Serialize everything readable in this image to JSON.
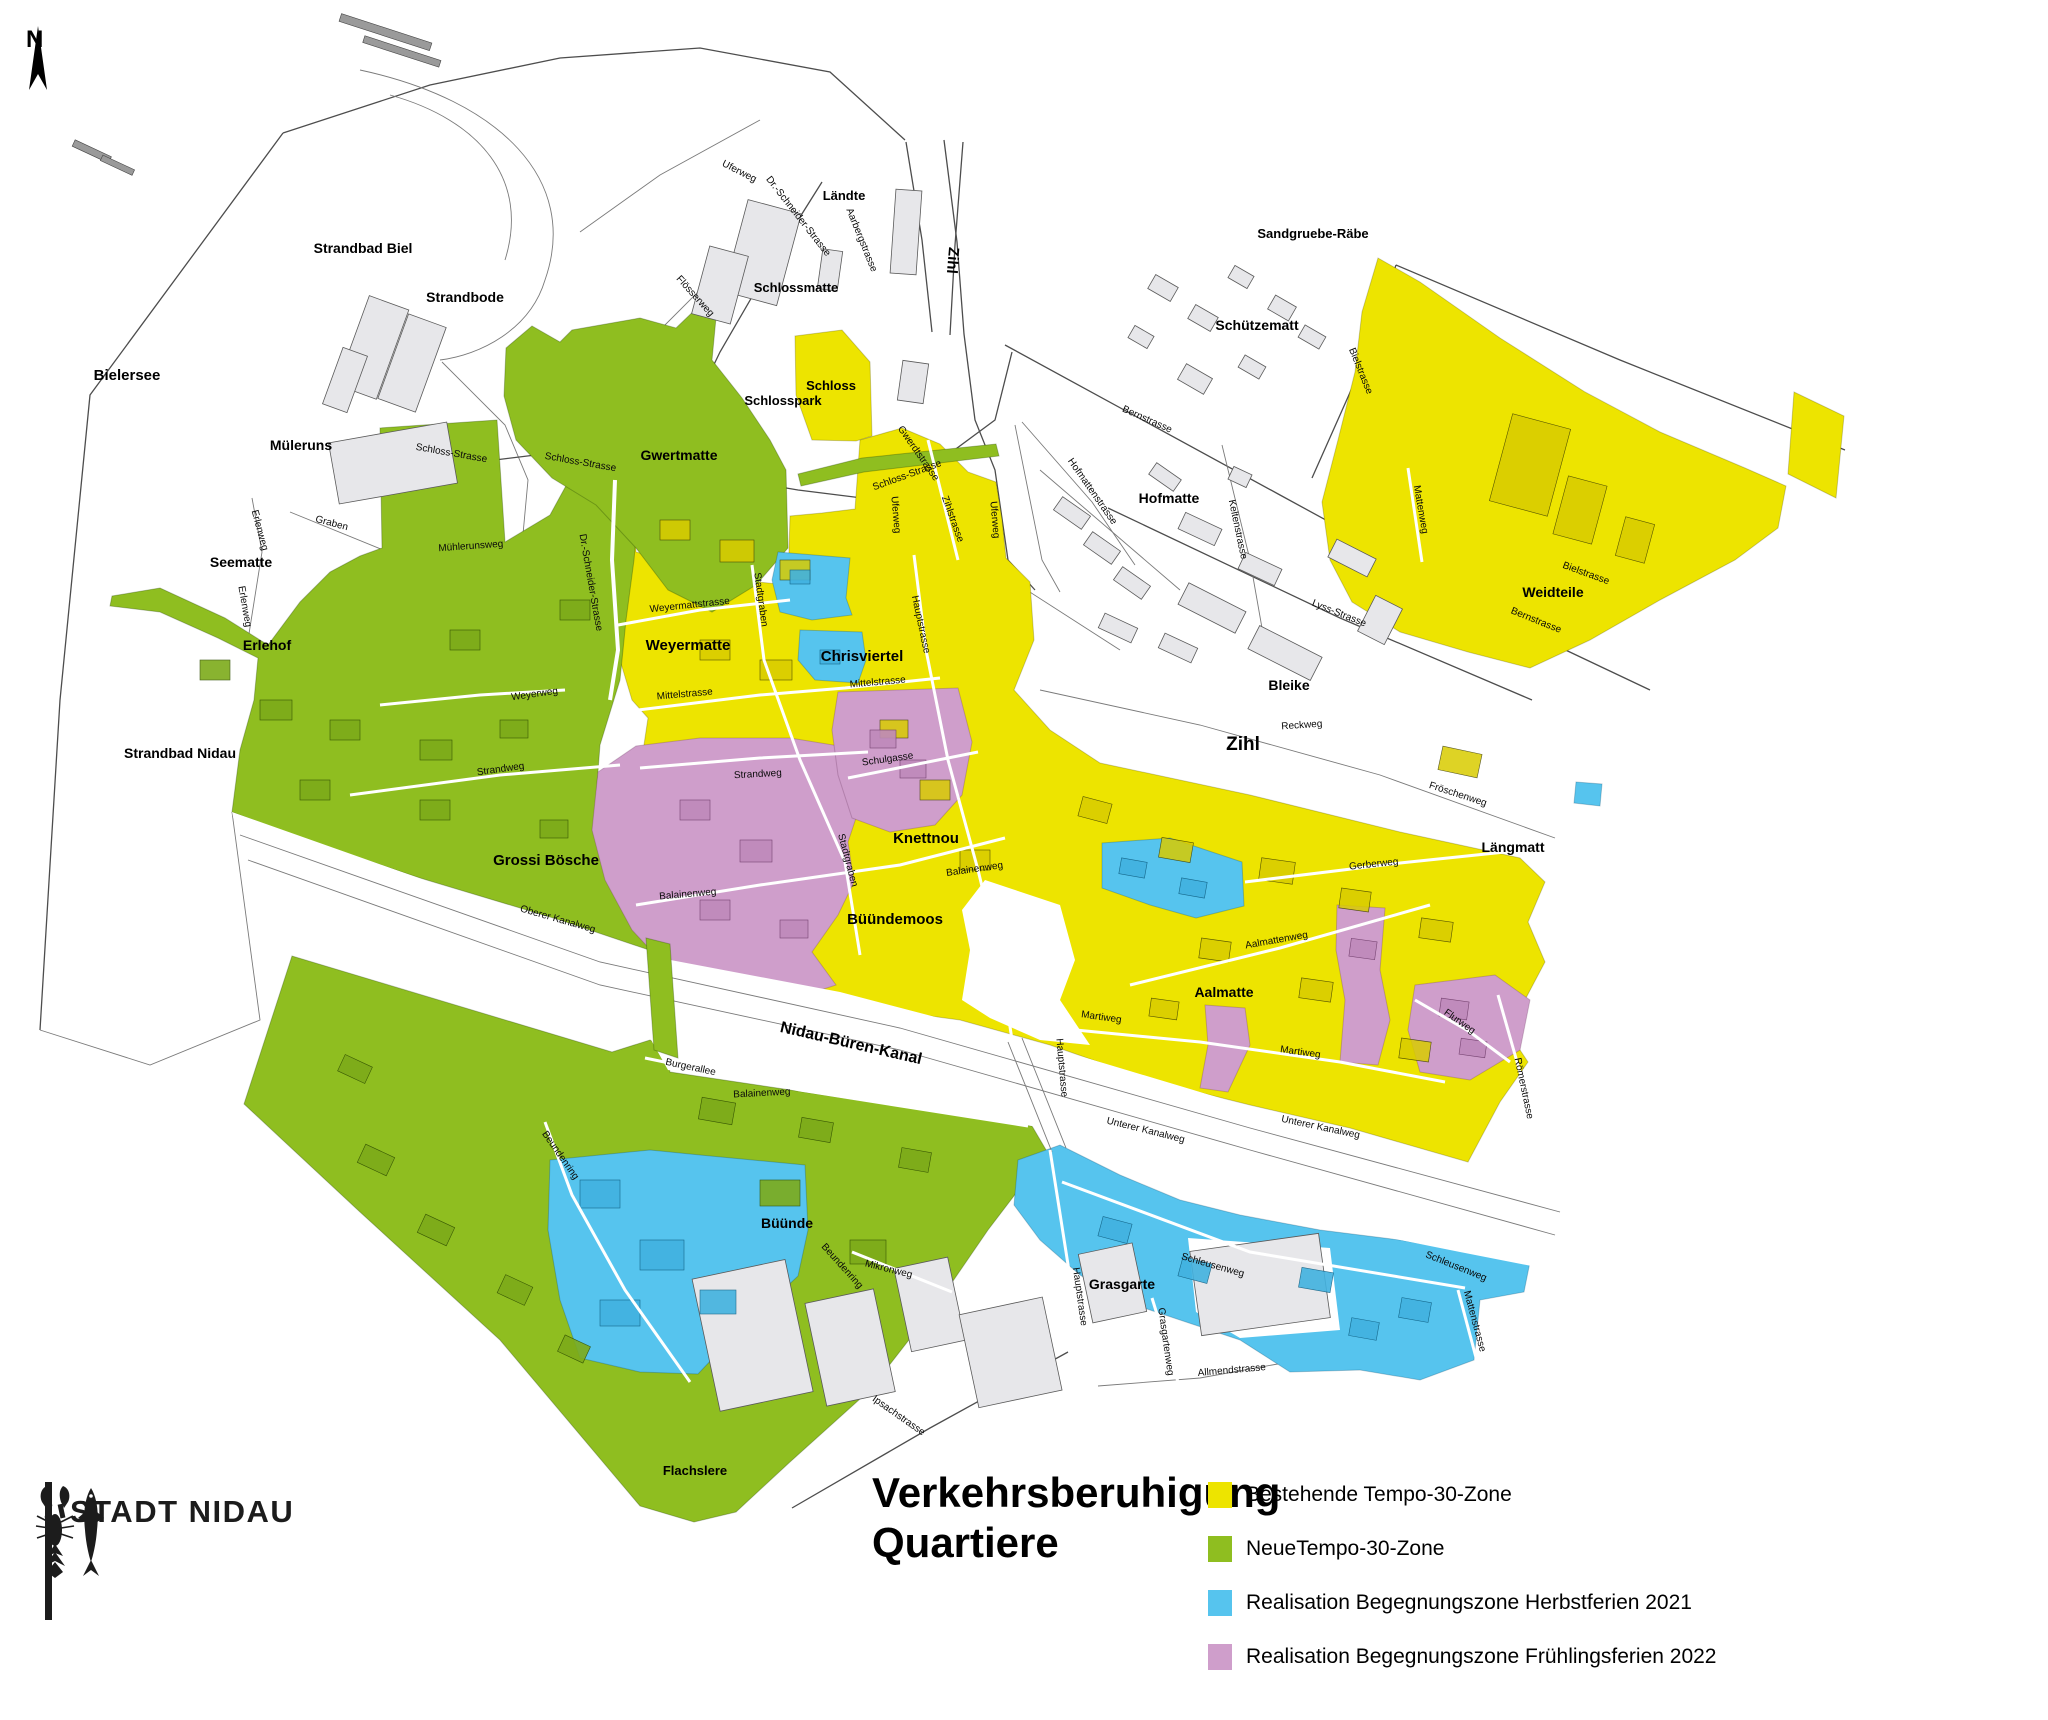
{
  "page": {
    "title_line1": "Verkehrsberuhigung",
    "title_line2": "Quartiere"
  },
  "logo": {
    "name": "STADT NIDAU"
  },
  "compass": {
    "label": "N"
  },
  "legend": {
    "items": [
      {
        "key": "existing30",
        "color": "#EDE400",
        "label": "Bestehende Tempo-30-Zone"
      },
      {
        "key": "new30",
        "color": "#8FBE20",
        "label": "NeueTempo-30-Zone"
      },
      {
        "key": "meet2021",
        "color": "#56C4EE",
        "label": "Realisation Begegnungszone Herbstferien 2021"
      },
      {
        "key": "meet2022",
        "color": "#CF9ECB",
        "label": "Realisation Begegnungszone Frühlingsferien 2022"
      }
    ]
  },
  "map": {
    "colors": {
      "road": "#4d4d4d",
      "water_line": "#8a8a8a",
      "building": "#e7e7ea"
    },
    "area_labels": [
      {
        "t": "Bielersee",
        "x": 127,
        "y": 380,
        "s": 15
      },
      {
        "t": "Strandbad Biel",
        "x": 363,
        "y": 253,
        "s": 14
      },
      {
        "t": "Strandbode",
        "x": 465,
        "y": 302,
        "s": 14
      },
      {
        "t": "Müleruns",
        "x": 301,
        "y": 450,
        "s": 14
      },
      {
        "t": "Seematte",
        "x": 241,
        "y": 567,
        "s": 14
      },
      {
        "t": "Erlehof",
        "x": 267,
        "y": 650,
        "s": 14
      },
      {
        "t": "Strandbad Nidau",
        "x": 180,
        "y": 758,
        "s": 14
      },
      {
        "t": "Grossi Bösche",
        "x": 546,
        "y": 865,
        "s": 15
      },
      {
        "t": "Gwertmatte",
        "x": 679,
        "y": 460,
        "s": 14
      },
      {
        "t": "Weyermatte",
        "x": 688,
        "y": 650,
        "s": 15
      },
      {
        "t": "Chrisviertel",
        "x": 862,
        "y": 661,
        "s": 15
      },
      {
        "t": "Knettnou",
        "x": 926,
        "y": 843,
        "s": 15
      },
      {
        "t": "Büündemoos",
        "x": 895,
        "y": 924,
        "s": 15
      },
      {
        "t": "Schlossmatte",
        "x": 796,
        "y": 292,
        "s": 13
      },
      {
        "t": "Schlosspark",
        "x": 783,
        "y": 405,
        "s": 13
      },
      {
        "t": "Schloss",
        "x": 831,
        "y": 390,
        "s": 13
      },
      {
        "t": "Ländte",
        "x": 844,
        "y": 200,
        "s": 13
      },
      {
        "t": "Zihl",
        "x": 948,
        "y": 260,
        "s": 15,
        "r": 95
      },
      {
        "t": "Zihl",
        "x": 1243,
        "y": 750,
        "s": 19
      },
      {
        "t": "Sandgruebe-Räbe",
        "x": 1313,
        "y": 238,
        "s": 13
      },
      {
        "t": "Schützematt",
        "x": 1257,
        "y": 330,
        "s": 14
      },
      {
        "t": "Hofmatte",
        "x": 1169,
        "y": 503,
        "s": 14
      },
      {
        "t": "Bleike",
        "x": 1289,
        "y": 690,
        "s": 14
      },
      {
        "t": "Weidteile",
        "x": 1553,
        "y": 597,
        "s": 14
      },
      {
        "t": "Längmatt",
        "x": 1513,
        "y": 852,
        "s": 14
      },
      {
        "t": "Aalmatte",
        "x": 1224,
        "y": 997,
        "s": 14
      },
      {
        "t": "Büünde",
        "x": 787,
        "y": 1228,
        "s": 14
      },
      {
        "t": "Grasgarte",
        "x": 1122,
        "y": 1289,
        "s": 14
      },
      {
        "t": "Flachslere",
        "x": 695,
        "y": 1475,
        "s": 13
      },
      {
        "t": "Nidau-Büren-Kanal",
        "x": 850,
        "y": 1048,
        "s": 16,
        "r": 13
      }
    ],
    "street_labels": [
      {
        "t": "Uferweg",
        "x": 738,
        "y": 174,
        "r": 27
      },
      {
        "t": "Dr.-Schneider-Strasse",
        "x": 796,
        "y": 218,
        "r": 52
      },
      {
        "t": "Flösserweg",
        "x": 693,
        "y": 298,
        "r": 48
      },
      {
        "t": "Aarbergstrasse",
        "x": 859,
        "y": 241,
        "r": 68
      },
      {
        "t": "Schloss-Strasse",
        "x": 451,
        "y": 456,
        "r": 10
      },
      {
        "t": "Schloss-Strasse",
        "x": 580,
        "y": 465,
        "r": 10
      },
      {
        "t": "Schloss-Strasse",
        "x": 908,
        "y": 478,
        "r": -20
      },
      {
        "t": "Mühlerunsweg",
        "x": 471,
        "y": 549,
        "r": -4
      },
      {
        "t": "Graben",
        "x": 331,
        "y": 526,
        "r": 15
      },
      {
        "t": "Erlenweg",
        "x": 257,
        "y": 531,
        "r": 75
      },
      {
        "t": "Erlenweg",
        "x": 242,
        "y": 607,
        "r": 80
      },
      {
        "t": "Dr.-Schneider-Strasse",
        "x": 588,
        "y": 583,
        "r": 80
      },
      {
        "t": "Weyermattstrasse",
        "x": 690,
        "y": 608,
        "r": -6
      },
      {
        "t": "Weyerweg",
        "x": 535,
        "y": 697,
        "r": -8
      },
      {
        "t": "Strandweg",
        "x": 501,
        "y": 772,
        "r": -8
      },
      {
        "t": "Strandweg",
        "x": 758,
        "y": 777,
        "r": -3
      },
      {
        "t": "Mittelstrasse",
        "x": 685,
        "y": 697,
        "r": -5
      },
      {
        "t": "Mittelstrasse",
        "x": 878,
        "y": 685,
        "r": -5
      },
      {
        "t": "Stadtgraben",
        "x": 758,
        "y": 600,
        "r": 82
      },
      {
        "t": "Stadtgraben",
        "x": 845,
        "y": 861,
        "r": 75
      },
      {
        "t": "Schulgasse",
        "x": 888,
        "y": 762,
        "r": -8
      },
      {
        "t": "Hauptstrasse",
        "x": 918,
        "y": 625,
        "r": 78
      },
      {
        "t": "Hauptstrasse",
        "x": 1059,
        "y": 1068,
        "r": 85
      },
      {
        "t": "Hauptstrasse",
        "x": 1077,
        "y": 1297,
        "r": 82
      },
      {
        "t": "Zihlstrasse",
        "x": 950,
        "y": 520,
        "r": 70
      },
      {
        "t": "Gwerdtstrasse",
        "x": 916,
        "y": 455,
        "r": 55
      },
      {
        "t": "Bernstrasse",
        "x": 1146,
        "y": 422,
        "r": 24
      },
      {
        "t": "Bernstrasse",
        "x": 1535,
        "y": 623,
        "r": 22
      },
      {
        "t": "Bielstrasse",
        "x": 1358,
        "y": 372,
        "r": 68
      },
      {
        "t": "Bielstrasse",
        "x": 1585,
        "y": 576,
        "r": 20
      },
      {
        "t": "Mattenweg",
        "x": 1418,
        "y": 510,
        "r": 80
      },
      {
        "t": "Hofmattenstrasse",
        "x": 1090,
        "y": 493,
        "r": 55
      },
      {
        "t": "Keltenstrasse",
        "x": 1235,
        "y": 530,
        "r": 78
      },
      {
        "t": "Lyss-Strasse",
        "x": 1338,
        "y": 616,
        "r": 22
      },
      {
        "t": "Uferweg",
        "x": 893,
        "y": 515,
        "r": 85
      },
      {
        "t": "Uferweg",
        "x": 992,
        "y": 520,
        "r": 85
      },
      {
        "t": "Reckweg",
        "x": 1302,
        "y": 728,
        "r": -4
      },
      {
        "t": "Fröschenweg",
        "x": 1457,
        "y": 797,
        "r": 18
      },
      {
        "t": "Gerberweg",
        "x": 1374,
        "y": 867,
        "r": -6
      },
      {
        "t": "Aalmattenweg",
        "x": 1277,
        "y": 943,
        "r": -10
      },
      {
        "t": "Martiweg",
        "x": 1101,
        "y": 1020,
        "r": 8
      },
      {
        "t": "Martiweg",
        "x": 1300,
        "y": 1055,
        "r": 8
      },
      {
        "t": "Flurweg",
        "x": 1458,
        "y": 1024,
        "r": 35
      },
      {
        "t": "Römerstrasse",
        "x": 1521,
        "y": 1089,
        "r": 78
      },
      {
        "t": "Unterer Kanalweg",
        "x": 1145,
        "y": 1133,
        "r": 14
      },
      {
        "t": "Unterer Kanalweg",
        "x": 1320,
        "y": 1130,
        "r": 12
      },
      {
        "t": "Oberer Kanalweg",
        "x": 557,
        "y": 922,
        "r": 16
      },
      {
        "t": "Balainenweg",
        "x": 688,
        "y": 897,
        "r": -5
      },
      {
        "t": "Balainenweg",
        "x": 975,
        "y": 872,
        "r": -8
      },
      {
        "t": "Balainenweg",
        "x": 762,
        "y": 1096,
        "r": -3
      },
      {
        "t": "Burgerallee",
        "x": 690,
        "y": 1070,
        "r": 12
      },
      {
        "t": "Beundenring",
        "x": 558,
        "y": 1157,
        "r": 55
      },
      {
        "t": "Beundenring",
        "x": 840,
        "y": 1268,
        "r": 48
      },
      {
        "t": "Mikronweg",
        "x": 888,
        "y": 1272,
        "r": 14
      },
      {
        "t": "Grasgartenweg",
        "x": 1163,
        "y": 1342,
        "r": 82
      },
      {
        "t": "Ipsachstrasse",
        "x": 897,
        "y": 1418,
        "r": 35
      },
      {
        "t": "Allmendstrasse",
        "x": 1232,
        "y": 1373,
        "r": -5
      },
      {
        "t": "Schleusenweg",
        "x": 1212,
        "y": 1268,
        "r": 16
      },
      {
        "t": "Schleusenweg",
        "x": 1455,
        "y": 1269,
        "r": 22
      },
      {
        "t": "Mattenstrasse",
        "x": 1472,
        "y": 1322,
        "r": 75
      }
    ]
  }
}
